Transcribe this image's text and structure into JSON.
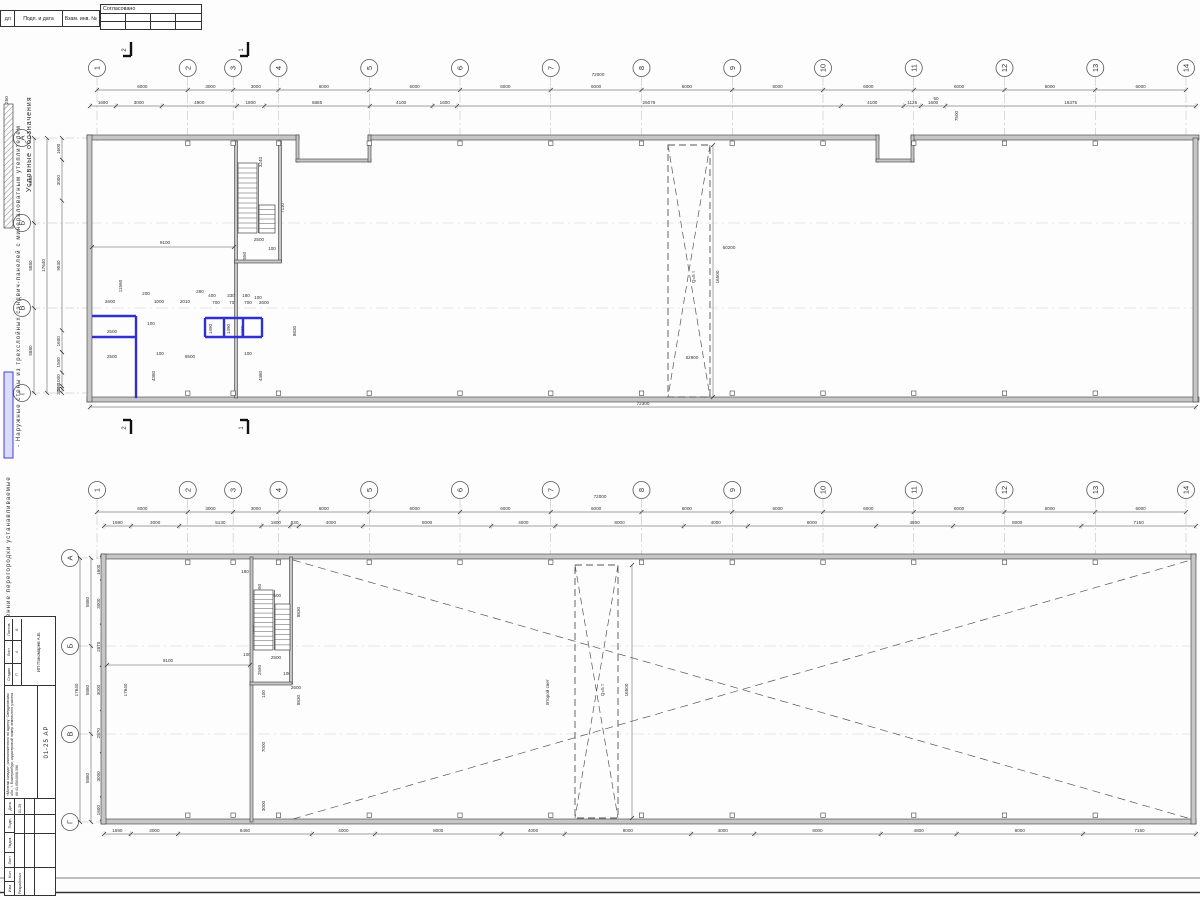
{
  "sheet": {
    "header": {
      "col1": "дл",
      "col2": "Подп. и дата",
      "col3": "Взам. инв. №",
      "approved": "Согласовано"
    },
    "legend": {
      "title": "Условные обозначения",
      "item1": "- Наружные стены из трехслойных сэндвич-панелей с минераловатным утеплителем",
      "item2": "- Внутренние перегородки устанавливаемые",
      "swatch_dim": "250",
      "partition_color": "#2f2fd4"
    },
    "titleblock": {
      "header_cols": [
        "Изм",
        "Кол",
        "Лист",
        "№док",
        "Подп.",
        "Дата"
      ],
      "developed_label": "Разработал",
      "developed_date": "01.25",
      "description": "«Монтаж склада», расположенного по адресу: Свердловская обл., г. Екатеринбург, кадастровый номер земельного участка 66:41:0504008:396",
      "doc_number": "01-25 АР",
      "stage_label": "Стадия",
      "sheet_label": "Лист",
      "sheets_label": "Листов",
      "stage": "П",
      "sheet": "4",
      "sheets": "6",
      "company": "ИП Пономарев А.В."
    }
  },
  "plans": [
    {
      "col_labels": [
        "1",
        "2",
        "3",
        "4",
        "5",
        "6",
        "7",
        "8",
        "9",
        "10",
        "11",
        "12",
        "13",
        "14"
      ],
      "col_spans": [
        6000,
        3000,
        3000,
        6000,
        6000,
        6000,
        6000,
        6000,
        6000,
        6000,
        6000,
        6000,
        6000
      ],
      "row_labels": [
        "А",
        "Б",
        "В",
        "Г"
      ],
      "row_outer": [
        17640
      ],
      "row_mid": [
        5880,
        5880,
        5880
      ],
      "row_inner": [
        1600,
        3000,
        9530,
        1600,
        1500,
        1000,
        200,
        300
      ],
      "top_sub": [
        1690,
        3000,
        4900,
        1800,
        6885,
        4100,
        1600,
        25075,
        4100,
        1125,
        1600,
        16375
      ],
      "bottom": [
        72300
      ],
      "section_marks": [
        {
          "x": 131,
          "y": 42,
          "label": "2",
          "bar": "bottom"
        },
        {
          "x": 248,
          "y": 42,
          "label": "1",
          "bar": "bottom"
        },
        {
          "x": 131,
          "y": 420,
          "label": "2",
          "bar": "top"
        },
        {
          "x": 248,
          "y": 420,
          "label": "1",
          "bar": "top"
        }
      ],
      "annotations": [
        {
          "t": "72000",
          "x": 598,
          "y": 76
        },
        {
          "t": "11560",
          "x": 122,
          "y": 286,
          "r": 1
        },
        {
          "t": "9100",
          "x": 165,
          "y": 244
        },
        {
          "t": "3240",
          "x": 262,
          "y": 162,
          "r": 1
        },
        {
          "t": "7110",
          "x": 284,
          "y": 208,
          "r": 1
        },
        {
          "t": "2500",
          "x": 259,
          "y": 241
        },
        {
          "t": "2550",
          "x": 246,
          "y": 257,
          "r": 1
        },
        {
          "t": "100",
          "x": 272,
          "y": 250
        },
        {
          "t": "100",
          "x": 251,
          "y": 233
        },
        {
          "t": "2600",
          "x": 110,
          "y": 303
        },
        {
          "t": "200",
          "x": 146,
          "y": 295
        },
        {
          "t": "1000",
          "x": 159,
          "y": 303
        },
        {
          "t": "2010",
          "x": 185,
          "y": 303
        },
        {
          "t": "280",
          "x": 200,
          "y": 293
        },
        {
          "t": "400",
          "x": 212,
          "y": 297
        },
        {
          "t": "700",
          "x": 216,
          "y": 304
        },
        {
          "t": "330",
          "x": 231,
          "y": 297
        },
        {
          "t": "700",
          "x": 233,
          "y": 304
        },
        {
          "t": "180",
          "x": 246,
          "y": 297
        },
        {
          "t": "700",
          "x": 248,
          "y": 304
        },
        {
          "t": "100",
          "x": 258,
          "y": 299
        },
        {
          "t": "2600",
          "x": 264,
          "y": 304
        },
        {
          "t": "2500",
          "x": 112,
          "y": 333
        },
        {
          "t": "100",
          "x": 151,
          "y": 325
        },
        {
          "t": "1490",
          "x": 212,
          "y": 329,
          "r": 1
        },
        {
          "t": "1490",
          "x": 230,
          "y": 329,
          "r": 1
        },
        {
          "t": "1000",
          "x": 244,
          "y": 331,
          "r": 1
        },
        {
          "t": "2500",
          "x": 112,
          "y": 358
        },
        {
          "t": "100",
          "x": 160,
          "y": 355
        },
        {
          "t": "6500",
          "x": 190,
          "y": 358
        },
        {
          "t": "100",
          "x": 248,
          "y": 355
        },
        {
          "t": "4380",
          "x": 155,
          "y": 376,
          "r": 1
        },
        {
          "t": "4380",
          "x": 262,
          "y": 376,
          "r": 1
        },
        {
          "t": "8830",
          "x": 296,
          "y": 331,
          "r": 1
        },
        {
          "t": "60200",
          "x": 729,
          "y": 249
        },
        {
          "t": "16500",
          "x": 719,
          "y": 277,
          "r": 1
        },
        {
          "t": "62800",
          "x": 692,
          "y": 359
        },
        {
          "t": "Q=5 т",
          "x": 695,
          "y": 277,
          "r": 1
        },
        {
          "t": "7500",
          "x": 958,
          "y": 116,
          "r": 1
        },
        {
          "t": "50",
          "x": 936,
          "y": 100
        }
      ]
    },
    {
      "col_labels": [
        "1",
        "2",
        "3",
        "4",
        "5",
        "6",
        "7",
        "8",
        "9",
        "10",
        "11",
        "12",
        "13",
        "14"
      ],
      "col_spans": [
        6000,
        3000,
        3000,
        6000,
        6000,
        6000,
        6000,
        6000,
        6000,
        6000,
        6000,
        6000,
        6000
      ],
      "row_labels": [
        "А",
        "Б",
        "В",
        "Г"
      ],
      "row_outer": [
        17640
      ],
      "row_mid": [
        5880,
        5880,
        5880
      ],
      "row_inner": [
        1600,
        3000,
        2870,
        3000,
        2870,
        3000,
        1600
      ],
      "top_sub": [
        1690,
        3000,
        5130,
        1800,
        530,
        4000,
        8000,
        4000,
        8000,
        4000,
        8000,
        4800,
        8000,
        7150
      ],
      "bottom": [
        1690,
        3000,
        8460,
        4000,
        8000,
        4000,
        8000,
        4000,
        8000,
        4800,
        8000,
        7150
      ],
      "section_marks": [],
      "annotations": [
        {
          "t": "72000",
          "x": 600,
          "y": 498
        },
        {
          "t": "9100",
          "x": 168,
          "y": 662
        },
        {
          "t": "2500",
          "x": 276,
          "y": 597
        },
        {
          "t": "2550",
          "x": 261,
          "y": 589,
          "r": 1
        },
        {
          "t": "1200",
          "x": 253,
          "y": 580,
          "r": 1
        },
        {
          "t": "180",
          "x": 245,
          "y": 573
        },
        {
          "t": "7960",
          "x": 255,
          "y": 630,
          "r": 1
        },
        {
          "t": "2500",
          "x": 276,
          "y": 659
        },
        {
          "t": "100",
          "x": 247,
          "y": 656
        },
        {
          "t": "2550",
          "x": 261,
          "y": 670,
          "r": 1
        },
        {
          "t": "100",
          "x": 287,
          "y": 675
        },
        {
          "t": "2600",
          "x": 296,
          "y": 689
        },
        {
          "t": "100",
          "x": 265,
          "y": 694,
          "r": 1
        },
        {
          "t": "7000",
          "x": 265,
          "y": 747,
          "r": 1
        },
        {
          "t": "3000",
          "x": 265,
          "y": 806,
          "r": 1
        },
        {
          "t": "8830",
          "x": 300,
          "y": 700,
          "r": 1
        },
        {
          "t": "8830",
          "x": 300,
          "y": 612,
          "r": 1
        },
        {
          "t": "17640",
          "x": 127,
          "y": 690,
          "r": 1
        },
        {
          "t": "Второй свет",
          "x": 549,
          "y": 692,
          "r": 1
        },
        {
          "t": "Q=5 т",
          "x": 604,
          "y": 690,
          "r": 1
        },
        {
          "t": "16500",
          "x": 628,
          "y": 690,
          "r": 1
        }
      ]
    }
  ]
}
